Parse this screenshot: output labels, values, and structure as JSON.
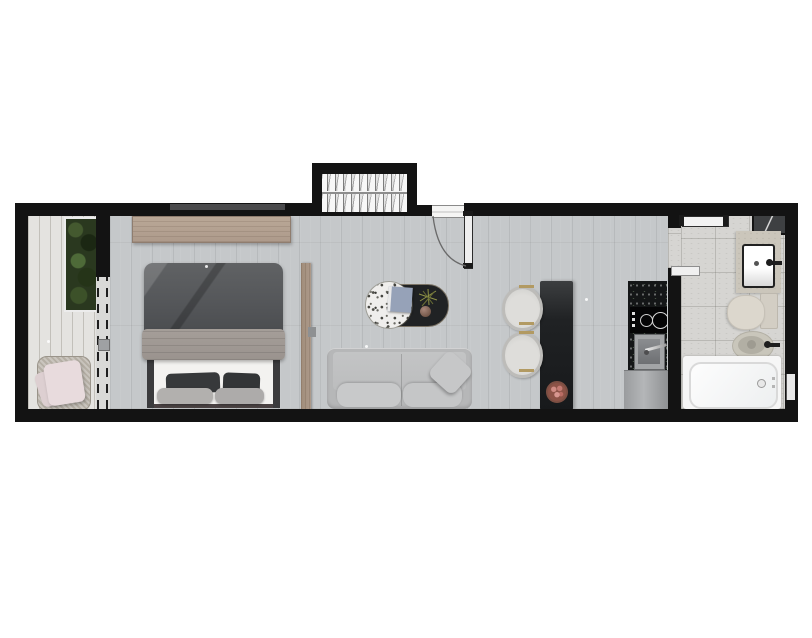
{
  "plan": {
    "type": "apartment-floor-plan",
    "description": "Top-down rendered floor plan of a narrow studio apartment with balcony, bedroom, living-dining area, kitchenette, bathroom and an external staircase block. No text labels are present in the drawing.",
    "rooms": [
      {
        "name": "balcony",
        "features": [
          "plank decking",
          "green planter strip",
          "lounge chair with pink cushions",
          "sliding glass door (dashed)"
        ]
      },
      {
        "name": "bedroom",
        "features": [
          "double bed with dark duvet",
          "four pillows",
          "wall-mounted wood shelf",
          "wood sliding panel"
        ]
      },
      {
        "name": "living-room",
        "features": [
          "gray three-seat sofa",
          "throw pillow",
          "oval coffee table with terrazzo top and black tray",
          "book",
          "decor sphere",
          "plant sprig",
          "entry door with swing arc"
        ]
      },
      {
        "name": "dining-kitchen",
        "features": [
          "black island table",
          "two round-back chairs with brass trim",
          "fruit bowl",
          "speckled stone counter",
          "two-burner cooktop",
          "stainless sink with faucet",
          "refrigerator cabinet"
        ]
      },
      {
        "name": "bathroom",
        "features": [
          "open door leaf",
          "stone vanity with rectangular basin",
          "toilet with tank",
          "bidet",
          "bathtub with drain",
          "corner mirror wedge"
        ]
      },
      {
        "name": "staircase",
        "features": [
          "enclosed two-flight stair with treads"
        ]
      }
    ],
    "colors": {
      "wall": "#131313",
      "main_floor": "#c5c8ca",
      "balcony_floor": "#e4e3e0",
      "bathroom_floor": "#d6d5d2",
      "wood_shelf": "#ad9a8b",
      "duvet": "#55575a",
      "blanket": "#9a938e",
      "mattress": "#f3f2f0",
      "sofa": "#b6b7b8",
      "island": "#202224",
      "counter": "#141617",
      "terrazzo": "#efeeec",
      "table_black": "#202224",
      "cushion_pink": "#e8dbdd",
      "plant_green": "#2a381f",
      "brass": "#b29a62",
      "tub_white": "#f6f6f6",
      "fixture_beige": "#dcd7cd",
      "book_blue": "#96a2b8"
    }
  }
}
